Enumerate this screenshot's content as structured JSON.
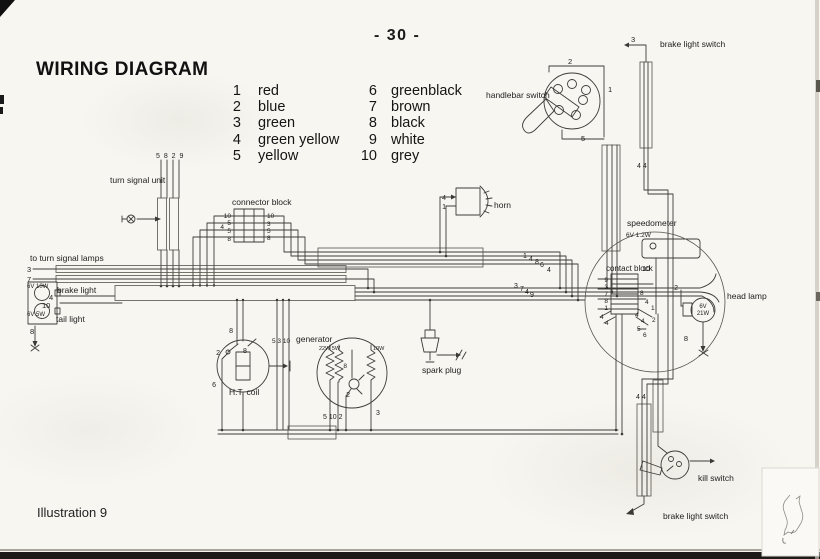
{
  "page": {
    "number": "- 30 -",
    "title": "WIRING DIAGRAM",
    "illustration": "Illustration 9"
  },
  "legend": {
    "columns": [
      [
        {
          "num": "1",
          "name": "red"
        },
        {
          "num": "2",
          "name": "blue"
        },
        {
          "num": "3",
          "name": "green"
        },
        {
          "num": "4",
          "name": "green yellow"
        },
        {
          "num": "5",
          "name": "yellow"
        }
      ],
      [
        {
          "num": "6",
          "name": "greenblack"
        },
        {
          "num": "7",
          "name": "brown"
        },
        {
          "num": "8",
          "name": "black"
        },
        {
          "num": "9",
          "name": "white"
        },
        {
          "num": "10",
          "name": "grey"
        }
      ]
    ]
  },
  "diagram": {
    "component_labels": [
      {
        "n": "turn-signal-unit-label",
        "t": "turn signal unit",
        "x": 110,
        "y": 183,
        "s": 8.5
      },
      {
        "n": "connector-block-label",
        "t": "connector block",
        "x": 232,
        "y": 205,
        "s": 8.5
      },
      {
        "n": "to-turn-signal-lamps-label",
        "t": "to turn signal lamps",
        "x": 30,
        "y": 261,
        "s": 8.5
      },
      {
        "n": "brake-light-label",
        "t": "brake light",
        "x": 57,
        "y": 293,
        "s": 8.5
      },
      {
        "n": "brake-light-rating",
        "t": "6V 10W",
        "x": 27,
        "y": 288,
        "s": 6
      },
      {
        "n": "tail-light-label",
        "t": "tail light",
        "x": 56,
        "y": 322,
        "s": 8.5
      },
      {
        "n": "tail-light-rating",
        "t": "6V 5W",
        "x": 27,
        "y": 316,
        "s": 6
      },
      {
        "n": "horn-label",
        "t": "horn",
        "x": 494,
        "y": 208,
        "s": 8.5
      },
      {
        "n": "handlebar-switch-label",
        "t": "handlebar switch",
        "x": 486,
        "y": 98,
        "s": 8.5
      },
      {
        "n": "brake-light-switch-top-label",
        "t": "brake light switch",
        "x": 660,
        "y": 47,
        "s": 8.5
      },
      {
        "n": "speedometer-label",
        "t": "speedometer",
        "x": 627,
        "y": 226,
        "s": 8.5
      },
      {
        "n": "speedometer-rating",
        "t": "6V 1.2W",
        "x": 626,
        "y": 237,
        "s": 6.5
      },
      {
        "n": "contact-block-label",
        "t": "contact block",
        "x": 606,
        "y": 271,
        "s": 8
      },
      {
        "n": "head-lamp-label",
        "t": "head lamp",
        "x": 727,
        "y": 299,
        "s": 8.5
      },
      {
        "n": "head-lamp-bulb-rating-line1",
        "t": "6V",
        "x": 703,
        "y": 308,
        "s": 6,
        "a": "m"
      },
      {
        "n": "head-lamp-bulb-rating-line2",
        "t": "21W",
        "x": 703,
        "y": 315,
        "s": 6,
        "a": "m"
      },
      {
        "n": "kill-switch-label",
        "t": "kill switch",
        "x": 698,
        "y": 481,
        "s": 8.5
      },
      {
        "n": "brake-light-switch-bottom-label",
        "t": "brake light switch",
        "x": 663,
        "y": 519,
        "s": 8.5
      },
      {
        "n": "generator-label",
        "t": "generator",
        "x": 296,
        "y": 342,
        "s": 8.5
      },
      {
        "n": "generator-coil-left-rating",
        "t": "22W 5W",
        "x": 319,
        "y": 350,
        "s": 5.5
      },
      {
        "n": "generator-coil-right-rating",
        "t": "10W",
        "x": 373,
        "y": 350,
        "s": 5.5
      },
      {
        "n": "ht-coil-label",
        "t": "H.T. coil",
        "x": 229,
        "y": 395,
        "s": 8.5
      },
      {
        "n": "spark-plug-label",
        "t": "spark plug",
        "x": 422,
        "y": 373,
        "s": 8.5
      }
    ],
    "wire_numbers": [
      {
        "t": "5 8 2 9",
        "x": 156,
        "y": 158,
        "s": 7,
        "ls": 1
      },
      {
        "t": "10",
        "x": 231,
        "y": 218,
        "s": 6.5,
        "a": "e"
      },
      {
        "t": "5",
        "x": 231,
        "y": 225,
        "s": 6.5,
        "a": "e"
      },
      {
        "t": "4",
        "x": 224,
        "y": 229,
        "s": 6.5,
        "a": "e"
      },
      {
        "t": "5",
        "x": 231,
        "y": 233,
        "s": 6.5,
        "a": "e"
      },
      {
        "t": "8",
        "x": 231,
        "y": 241,
        "s": 6.5,
        "a": "e"
      },
      {
        "t": "10",
        "x": 267,
        "y": 218,
        "s": 6.5
      },
      {
        "t": "3",
        "x": 267,
        "y": 226,
        "s": 6.5
      },
      {
        "t": "5",
        "x": 267,
        "y": 233,
        "s": 6.5
      },
      {
        "t": "8",
        "x": 267,
        "y": 240,
        "s": 6.5
      },
      {
        "t": "3",
        "x": 27,
        "y": 272,
        "s": 7.5
      },
      {
        "t": "7",
        "x": 27,
        "y": 282,
        "s": 7.5
      },
      {
        "t": "4",
        "x": 49,
        "y": 300,
        "s": 7.5
      },
      {
        "t": "10",
        "x": 42,
        "y": 308,
        "s": 7.5
      },
      {
        "t": "8",
        "x": 30,
        "y": 334,
        "s": 7.5
      },
      {
        "t": "4",
        "x": 446,
        "y": 200,
        "s": 7,
        "a": "e"
      },
      {
        "t": "1",
        "x": 446,
        "y": 209,
        "s": 7,
        "a": "e"
      },
      {
        "t": "2",
        "x": 568,
        "y": 64,
        "s": 7.5
      },
      {
        "t": "1",
        "x": 608,
        "y": 92,
        "s": 7.5
      },
      {
        "t": "5",
        "x": 581,
        "y": 141,
        "s": 7.5
      },
      {
        "t": "3",
        "x": 631,
        "y": 42,
        "s": 7.5
      },
      {
        "t": "4 4",
        "x": 637,
        "y": 168,
        "s": 7
      },
      {
        "t": "10",
        "x": 650,
        "y": 271,
        "s": 7,
        "a": "e"
      },
      {
        "t": "2",
        "x": 678,
        "y": 290,
        "s": 7,
        "a": "e"
      },
      {
        "t": "9",
        "x": 608,
        "y": 282,
        "s": 6.5,
        "a": "e"
      },
      {
        "t": "3",
        "x": 608,
        "y": 289,
        "s": 6.5,
        "a": "e"
      },
      {
        "t": "7",
        "x": 608,
        "y": 296,
        "s": 6.5,
        "a": "e"
      },
      {
        "t": "8",
        "x": 608,
        "y": 303,
        "s": 6.5,
        "a": "e"
      },
      {
        "t": "1",
        "x": 608,
        "y": 310,
        "s": 6.5,
        "a": "e"
      },
      {
        "t": "4",
        "x": 600,
        "y": 319,
        "s": 6.5
      },
      {
        "t": "4",
        "x": 605,
        "y": 325,
        "s": 6.5
      },
      {
        "t": "8",
        "x": 640,
        "y": 295,
        "s": 6.5
      },
      {
        "t": "4",
        "x": 645,
        "y": 304,
        "s": 6.5
      },
      {
        "t": "1",
        "x": 651,
        "y": 310,
        "s": 6.5
      },
      {
        "t": "4",
        "x": 635,
        "y": 317,
        "s": 6.5
      },
      {
        "t": "4",
        "x": 641,
        "y": 323,
        "s": 6.5
      },
      {
        "t": "2",
        "x": 652,
        "y": 322,
        "s": 6.5
      },
      {
        "t": "5",
        "x": 637,
        "y": 331,
        "s": 6.5
      },
      {
        "t": "6",
        "x": 643,
        "y": 337,
        "s": 6.5
      },
      {
        "t": "1",
        "x": 523,
        "y": 258,
        "s": 7
      },
      {
        "t": "4",
        "x": 529,
        "y": 261,
        "s": 7
      },
      {
        "t": "8",
        "x": 535,
        "y": 264,
        "s": 7
      },
      {
        "t": "6",
        "x": 540,
        "y": 267,
        "s": 7
      },
      {
        "t": "4",
        "x": 547,
        "y": 272,
        "s": 7
      },
      {
        "t": "3",
        "x": 514,
        "y": 288,
        "s": 7
      },
      {
        "t": "7",
        "x": 520,
        "y": 291,
        "s": 7
      },
      {
        "t": "4",
        "x": 525,
        "y": 294,
        "s": 7
      },
      {
        "t": "9",
        "x": 530,
        "y": 297,
        "s": 7
      },
      {
        "t": "8",
        "x": 688,
        "y": 341,
        "s": 7.5,
        "a": "e"
      },
      {
        "t": "4 4",
        "x": 636,
        "y": 399,
        "s": 7
      },
      {
        "t": "8",
        "x": 233,
        "y": 333,
        "s": 7,
        "a": "e"
      },
      {
        "t": "2",
        "x": 220,
        "y": 355,
        "s": 7,
        "a": "e"
      },
      {
        "t": "8",
        "x": 243,
        "y": 353,
        "s": 7
      },
      {
        "t": "6",
        "x": 216,
        "y": 387,
        "s": 7,
        "a": "e"
      },
      {
        "t": "5 3 10",
        "x": 272,
        "y": 343,
        "s": 6.5
      },
      {
        "t": "8",
        "x": 347,
        "y": 368,
        "s": 6.5,
        "a": "e"
      },
      {
        "t": "2",
        "x": 350,
        "y": 397,
        "s": 7,
        "a": "e"
      },
      {
        "t": "5 10 2",
        "x": 323,
        "y": 419,
        "s": 7
      },
      {
        "t": "3",
        "x": 376,
        "y": 415,
        "s": 7
      }
    ]
  }
}
